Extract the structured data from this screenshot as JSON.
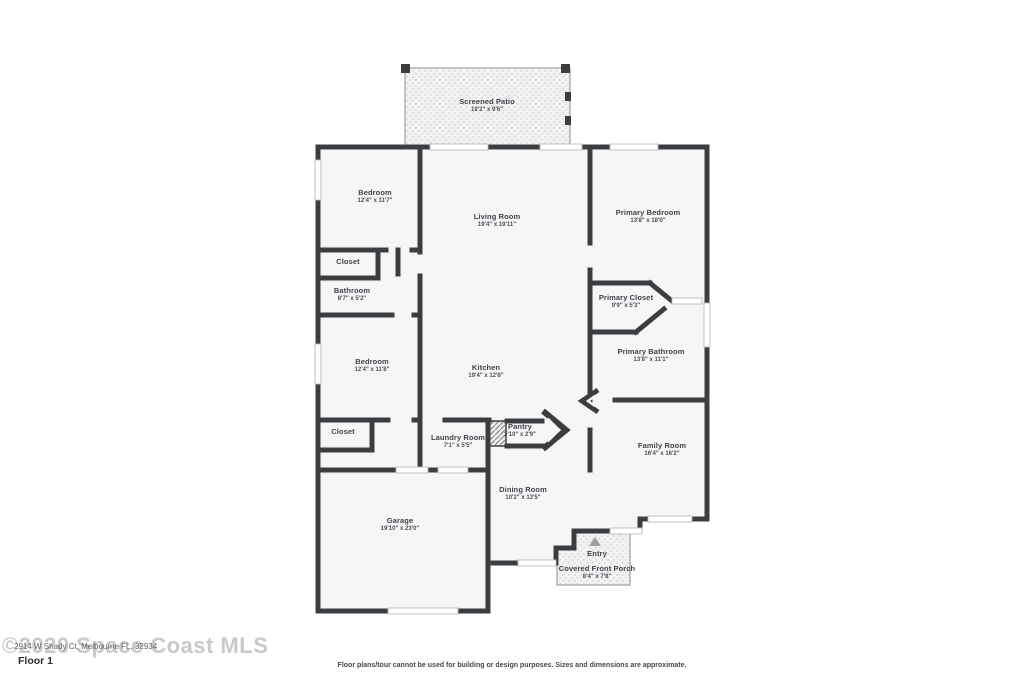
{
  "rooms": [
    {
      "name": "Screened Patio",
      "dims": "19'2\" x 9'6\""
    },
    {
      "name": "Bedroom",
      "dims": "12'4\" x 11'7\""
    },
    {
      "name": "Living Room",
      "dims": "19'4\" x 19'11\""
    },
    {
      "name": "Primary Bedroom",
      "dims": "13'8\" x 18'0\""
    },
    {
      "name": "Closet",
      "dims": ""
    },
    {
      "name": "Bathroom",
      "dims": "8'7\" x 5'2\""
    },
    {
      "name": "Primary Closet",
      "dims": "9'9\" x 5'3\""
    },
    {
      "name": "Bedroom",
      "dims": "12'4\" x 11'8\""
    },
    {
      "name": "Kitchen",
      "dims": "19'4\" x 12'8\""
    },
    {
      "name": "Primary Bathroom",
      "dims": "13'8\" x 11'1\""
    },
    {
      "name": "Closet",
      "dims": ""
    },
    {
      "name": "Laundry Room",
      "dims": "7'1\" x 5'5\""
    },
    {
      "name": "Pantry",
      "dims": "3'10\" x 2'9\""
    },
    {
      "name": "Family Room",
      "dims": "16'4\" x 16'2\""
    },
    {
      "name": "Garage",
      "dims": "19'10\" x 23'0\""
    },
    {
      "name": "Dining Room",
      "dims": "10'2\" x 13'5\""
    },
    {
      "name": "Entry",
      "dims": ""
    },
    {
      "name": "Covered Front Porch",
      "dims": "8'4\" x 7'8\""
    }
  ],
  "watermark": {
    "copyright": "©2020 Space Coast MLS",
    "address": "2914 W Shady Ct, Melbourne FL, 32934",
    "floor_label": "Floor 1"
  },
  "disclaimer": "Floor plans/tour cannot be used for building or design purposes. Sizes and dimensions are approximate.",
  "colors": {
    "wall": "#3b3e41",
    "room_fill": "#f6f6f7",
    "pattern_dot": "#dcdcde",
    "window_stroke": "#b7bbc0",
    "label_text": "#3f444a"
  }
}
